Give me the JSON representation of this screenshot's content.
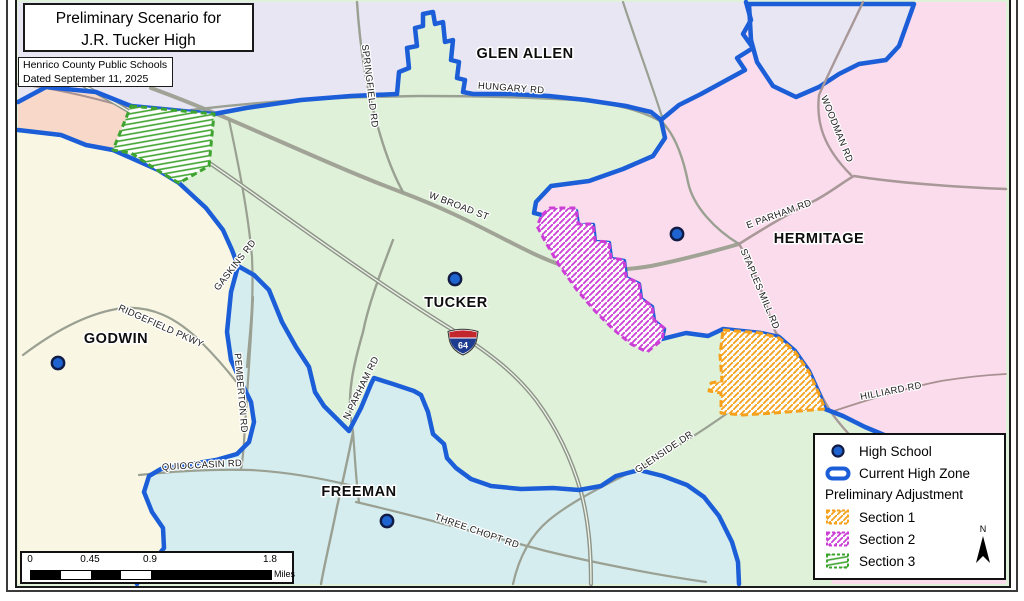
{
  "header": {
    "title_line1": "Preliminary Scenario for",
    "title_line2": "J.R. Tucker High",
    "org": "Henrico County Public Schools",
    "dated": "Dated September 11, 2025"
  },
  "zone_labels": {
    "glen_allen": "GLEN ALLEN",
    "hermitage": "HERMITAGE",
    "tucker": "TUCKER",
    "godwin": "GODWIN",
    "freeman": "FREEMAN"
  },
  "road_labels": {
    "springfield": "SPRINGFIELD RD",
    "hungary": "HUNGARY RD",
    "w_broad": "W BROAD ST",
    "e_parham": "E PARHAM RD",
    "woodman": "WOODMAN RD",
    "staples_mill": "STAPLES MILL RD",
    "hilliard": "HILLIARD RD",
    "glenside": "GLENSIDE DR",
    "gaskins": "GASKINS RD",
    "ridgefield": "RIDGEFIELD PKWY",
    "pemberton": "PEMBERTON RD",
    "quioccasin": "QUIOCCASIN RD",
    "n_parham": "N PARHAM RD",
    "three_chopt": "THREE CHOPT RD"
  },
  "interstate_shield": {
    "number": "64"
  },
  "legend": {
    "high_school_label": "High School",
    "current_zone_label": "Current High Zone",
    "adjustment_heading": "Preliminary Adjustment",
    "section1_label": "Section 1",
    "section2_label": "Section 2",
    "section3_label": "Section 3",
    "north_label": "N"
  },
  "scale_bar": {
    "tick0": "0",
    "tick1": "0.45",
    "tick2": "0.9",
    "tick3": "1.8",
    "unit": "Miles"
  },
  "colors": {
    "current_zone_blue": "#1b5ed8",
    "section1_orange": "#f5a11c",
    "section2_magenta": "#cc3fd6",
    "section3_green": "#3fa32f",
    "zone_tucker_green": "#dff2d9",
    "zone_glen_allen_lavender": "#e9e6f4",
    "zone_hermitage_pink": "#fbdcec",
    "zone_godwin_cream": "#f9f7e3",
    "zone_freeman_cyan": "#d6edf0",
    "zone_northwest_salmon": "#f8d9c9",
    "school_dot_blue": "#1e63cf"
  }
}
